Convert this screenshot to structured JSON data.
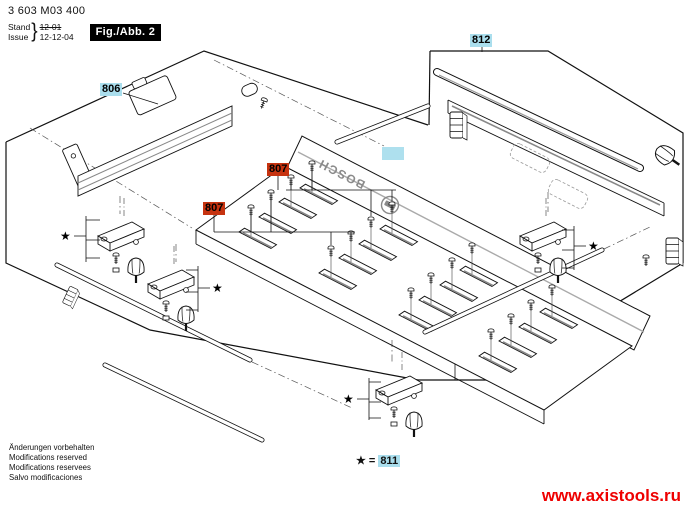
{
  "header": {
    "part_number": "3 603 M03 400",
    "stand_label": "Stand",
    "issue_label": "Issue",
    "brace": "}",
    "old_date": "12-01",
    "new_date": "12-12-04",
    "figure_label": "Fig./Abb. 2"
  },
  "diagram": {
    "brand": "BOSCH",
    "star_symbol": "★",
    "part_806": "806",
    "part_812": "812",
    "part_807_upper": "807",
    "part_807_lower": "807",
    "legend": {
      "star": "★",
      "equals": "=",
      "part_811": "811"
    },
    "highlight_colors": {
      "cyan": "#aadeed",
      "red": "#c63310"
    }
  },
  "footer": {
    "notes": [
      "Änderungen vorbehalten",
      "Modifications reserved",
      "Modifications reservees",
      "Salvo modificaciones"
    ],
    "watermark": "www.axistools.ru",
    "watermark_color": "#ee0000"
  }
}
